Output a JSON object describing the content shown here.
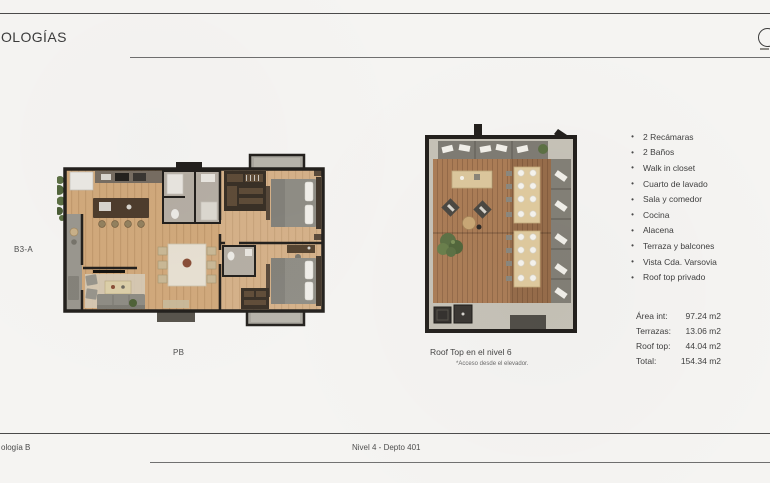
{
  "header": {
    "title": "OLOGÍAS"
  },
  "floorplan": {
    "label": "B3-A",
    "caption": "PB"
  },
  "rooftop": {
    "caption": "Roof Top en el nivel 6",
    "note": "*Acceso desde el elevador."
  },
  "features": {
    "bullet": "•",
    "items": [
      "2 Recámaras",
      "2 Baños",
      "Walk in closet",
      "Cuarto de lavado",
      "Sala y comedor",
      "Cocina",
      "Alacena",
      "Terraza y balcones",
      "Vista Cda. Varsovia",
      "Roof top privado"
    ]
  },
  "areas": {
    "rows": [
      {
        "label": "Área int:",
        "value": "97.24 m2"
      },
      {
        "label": "Terrazas:",
        "value": "13.06 m2"
      },
      {
        "label": "Roof top:",
        "value": "44.04 m2"
      },
      {
        "label": "Total:",
        "value": "154.34 m2"
      }
    ]
  },
  "footer": {
    "left": "ología B",
    "center": "Nivel 4 - Depto 401"
  },
  "colors": {
    "background": "#f5f4f2",
    "rule_line": "#4a4a4a",
    "text": "#3f3f3f",
    "wall_black": "#23201d",
    "wood_floor": "#d1a97c",
    "deck_wood": "#ab7d57",
    "concrete_gray": "#c6c2b7",
    "terrace_gray": "#9a978f",
    "furniture_gray": "#838077",
    "table_wood": "#e0cb9f",
    "plant_green": "#5d7145"
  }
}
